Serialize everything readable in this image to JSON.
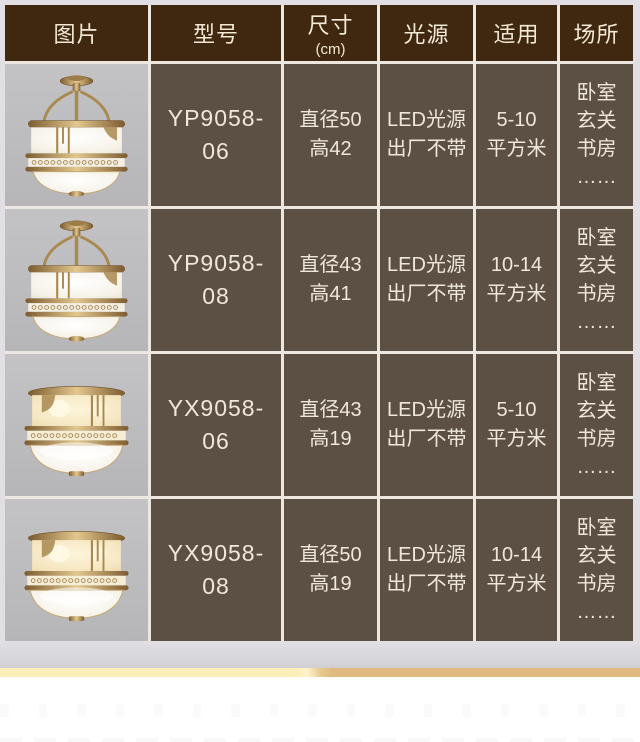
{
  "table": {
    "headers": [
      {
        "label": "图片",
        "sub": ""
      },
      {
        "label": "型号",
        "sub": ""
      },
      {
        "label": "尺寸",
        "sub": "(cm)"
      },
      {
        "label": "光源",
        "sub": ""
      },
      {
        "label": "适用",
        "sub": ""
      },
      {
        "label": "场所",
        "sub": ""
      }
    ],
    "rows": [
      {
        "image": {
          "name": "brass-semi-flush-ceiling-lamp",
          "type": "semi",
          "lit": false
        },
        "model": "YP9058-\n06",
        "size": "直径50\n高42",
        "light": "LED光源\n出厂不带",
        "area": "5-10\n平方米",
        "place": "卧室\n玄关\n书房\n……"
      },
      {
        "image": {
          "name": "brass-semi-flush-ceiling-lamp",
          "type": "semi",
          "lit": false
        },
        "model": "YP9058-\n08",
        "size": "直径43\n高41",
        "light": "LED光源\n出厂不带",
        "area": "10-14\n平方米",
        "place": "卧室\n玄关\n书房\n……"
      },
      {
        "image": {
          "name": "brass-flush-mount-ceiling-lamp",
          "type": "flush",
          "lit": true
        },
        "model": "YX9058-\n06",
        "size": "直径43\n高19",
        "light": "LED光源\n出厂不带",
        "area": "5-10\n平方米",
        "place": "卧室\n玄关\n书房\n……"
      },
      {
        "image": {
          "name": "brass-flush-mount-ceiling-lamp",
          "type": "flush",
          "lit": true
        },
        "model": "YX9058-\n08",
        "size": "直径50\n高19",
        "light": "LED光源\n出厂不带",
        "area": "10-14\n平方米",
        "place": "卧室\n玄关\n书房\n……"
      }
    ]
  },
  "colors": {
    "header_bg": "#40270f",
    "cell_bg": "#5c5045",
    "cell_text": "#efe8da",
    "image_cell_bg": "#bcbcbe",
    "grid_line": "#ece8e1",
    "gold_band_light": "#fceeb8",
    "gold_band_dark": "#dfb97e",
    "gray_strip": "#d8d7dc"
  }
}
